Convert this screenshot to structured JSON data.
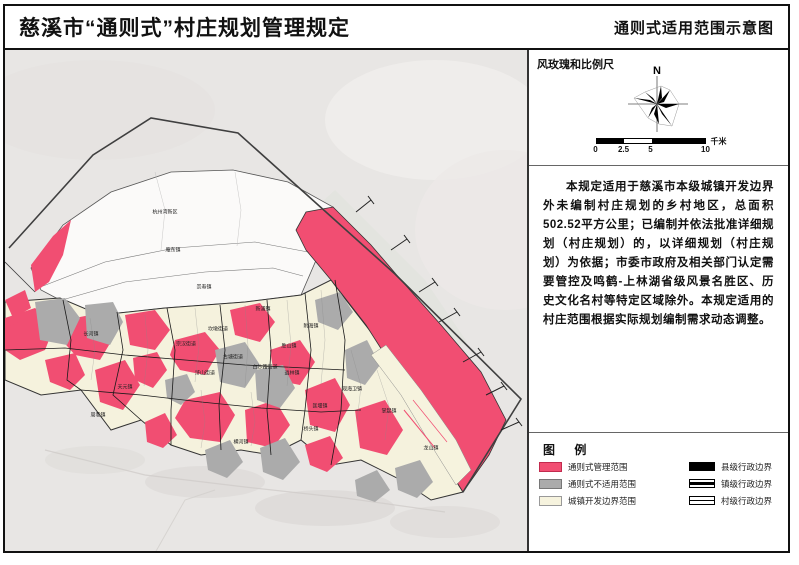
{
  "header": {
    "title_left": "慈溪市“通则式”村庄规划管理规定",
    "title_right": "通则式适用范围示意图"
  },
  "panel": {
    "compass_section_title": "风玫瑰和比例尺",
    "north_label": "N",
    "scalebar": {
      "ticks": [
        "0",
        "2.5",
        "5",
        "10"
      ],
      "unit": "千米"
    },
    "description": "本规定适用于慈溪市本级城镇开发边界外未编制村庄规划的乡村地区，总面积502.52平方公里；已编制并依法批准详细规划（村庄规划）的，以详细规划（村庄规划）为依据；市委市政府及相关部门认定需要管控及鸣鹤-上林湖省级风景名胜区、历史文化名村等特定区域除外。本规定适用的村庄范围根据实际规划编制需求动态调整。",
    "legend": {
      "title": "图 例",
      "area_items": [
        {
          "label": "通则式管理范围",
          "color": "#F14E72"
        },
        {
          "label": "通则式不适用范围",
          "color": "#ABABAB"
        },
        {
          "label": "城镇开发边界范围",
          "color": "#F6F3DE"
        }
      ],
      "line_items": [
        {
          "label": "县级行政边界",
          "style": "thick"
        },
        {
          "label": "镇级行政边界",
          "style": "medium"
        },
        {
          "label": "村级行政边界",
          "style": "thin"
        }
      ]
    }
  },
  "map": {
    "labels": [
      {
        "text": "杭州湾新区",
        "x": 160,
        "y": 163
      },
      {
        "text": "庵东镇",
        "x": 168,
        "y": 201
      },
      {
        "text": "崇寿镇",
        "x": 199,
        "y": 238
      },
      {
        "text": "长河镇",
        "x": 86,
        "y": 285
      },
      {
        "text": "天元镇",
        "x": 120,
        "y": 338
      },
      {
        "text": "周巷镇",
        "x": 93,
        "y": 366
      },
      {
        "text": "宗汉街道",
        "x": 181,
        "y": 295
      },
      {
        "text": "坎墩街道",
        "x": 213,
        "y": 280
      },
      {
        "text": "古塘街道",
        "x": 228,
        "y": 308
      },
      {
        "text": "白沙路街道",
        "x": 260,
        "y": 318
      },
      {
        "text": "浒山街道",
        "x": 200,
        "y": 324
      },
      {
        "text": "横河镇",
        "x": 236,
        "y": 393
      },
      {
        "text": "新浦镇",
        "x": 258,
        "y": 260
      },
      {
        "text": "胜山镇",
        "x": 284,
        "y": 297
      },
      {
        "text": "逍林镇",
        "x": 287,
        "y": 324
      },
      {
        "text": "桥头镇",
        "x": 306,
        "y": 380
      },
      {
        "text": "匡堰镇",
        "x": 315,
        "y": 357
      },
      {
        "text": "附海镇",
        "x": 306,
        "y": 277
      },
      {
        "text": "观海卫镇",
        "x": 347,
        "y": 340
      },
      {
        "text": "掌起镇",
        "x": 384,
        "y": 362
      },
      {
        "text": "龙山镇",
        "x": 426,
        "y": 399
      }
    ]
  }
}
